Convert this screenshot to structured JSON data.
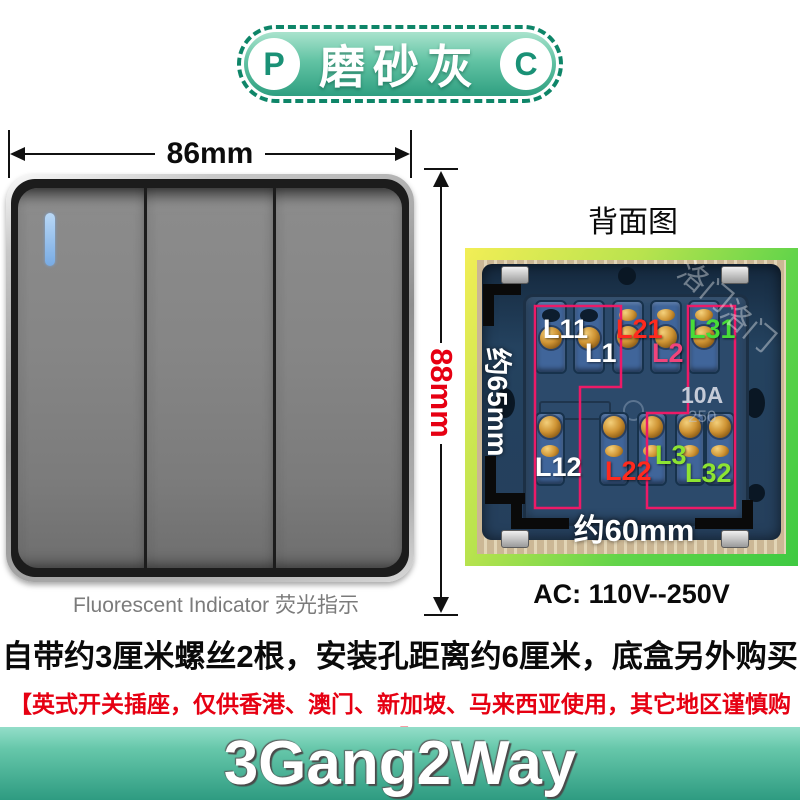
{
  "badge": {
    "left_letter": "P",
    "right_letter": "C",
    "title": "磨砂灰"
  },
  "front": {
    "width_label": "86mm",
    "height_label": "88mm",
    "caption": "Fluorescent Indicator 荧光指示"
  },
  "back": {
    "title": "背面图",
    "height_label": "约65mm",
    "width_label": "约60mm",
    "rating": "10A",
    "rating_sub": "250",
    "voltage": "AC: 110V--250V",
    "watermark1": "洛门",
    "watermark2": "洛门",
    "labels": [
      {
        "text": "L11",
        "color": "#ffffff"
      },
      {
        "text": "L1",
        "color": "#ffffff"
      },
      {
        "text": "L21",
        "color": "#ff2a1e"
      },
      {
        "text": "L2",
        "color": "#f0447c"
      },
      {
        "text": "L31",
        "color": "#47dd38"
      },
      {
        "text": "L12",
        "color": "#ffffff"
      },
      {
        "text": "L22",
        "color": "#ff2a1e"
      },
      {
        "text": "L3",
        "color": "#8de432"
      },
      {
        "text": "L32",
        "color": "#8de432"
      }
    ]
  },
  "notes": {
    "line1": "自带约3厘米螺丝2根，安装孔距离约6厘米，底盒另外购买",
    "line2": "【英式开关插座，仅供香港、澳门、新加坡、马来西亚使用，其它地区谨慎购买】"
  },
  "banner": {
    "label": "3Gang2Way"
  },
  "colors": {
    "accent_teal": "#2f9f81",
    "dimension_red": "#e60012",
    "note_red": "#e60012",
    "outline_pink": "#ed1a67",
    "frame_yellow": "#f2ee56",
    "frame_green": "#3fca42"
  }
}
